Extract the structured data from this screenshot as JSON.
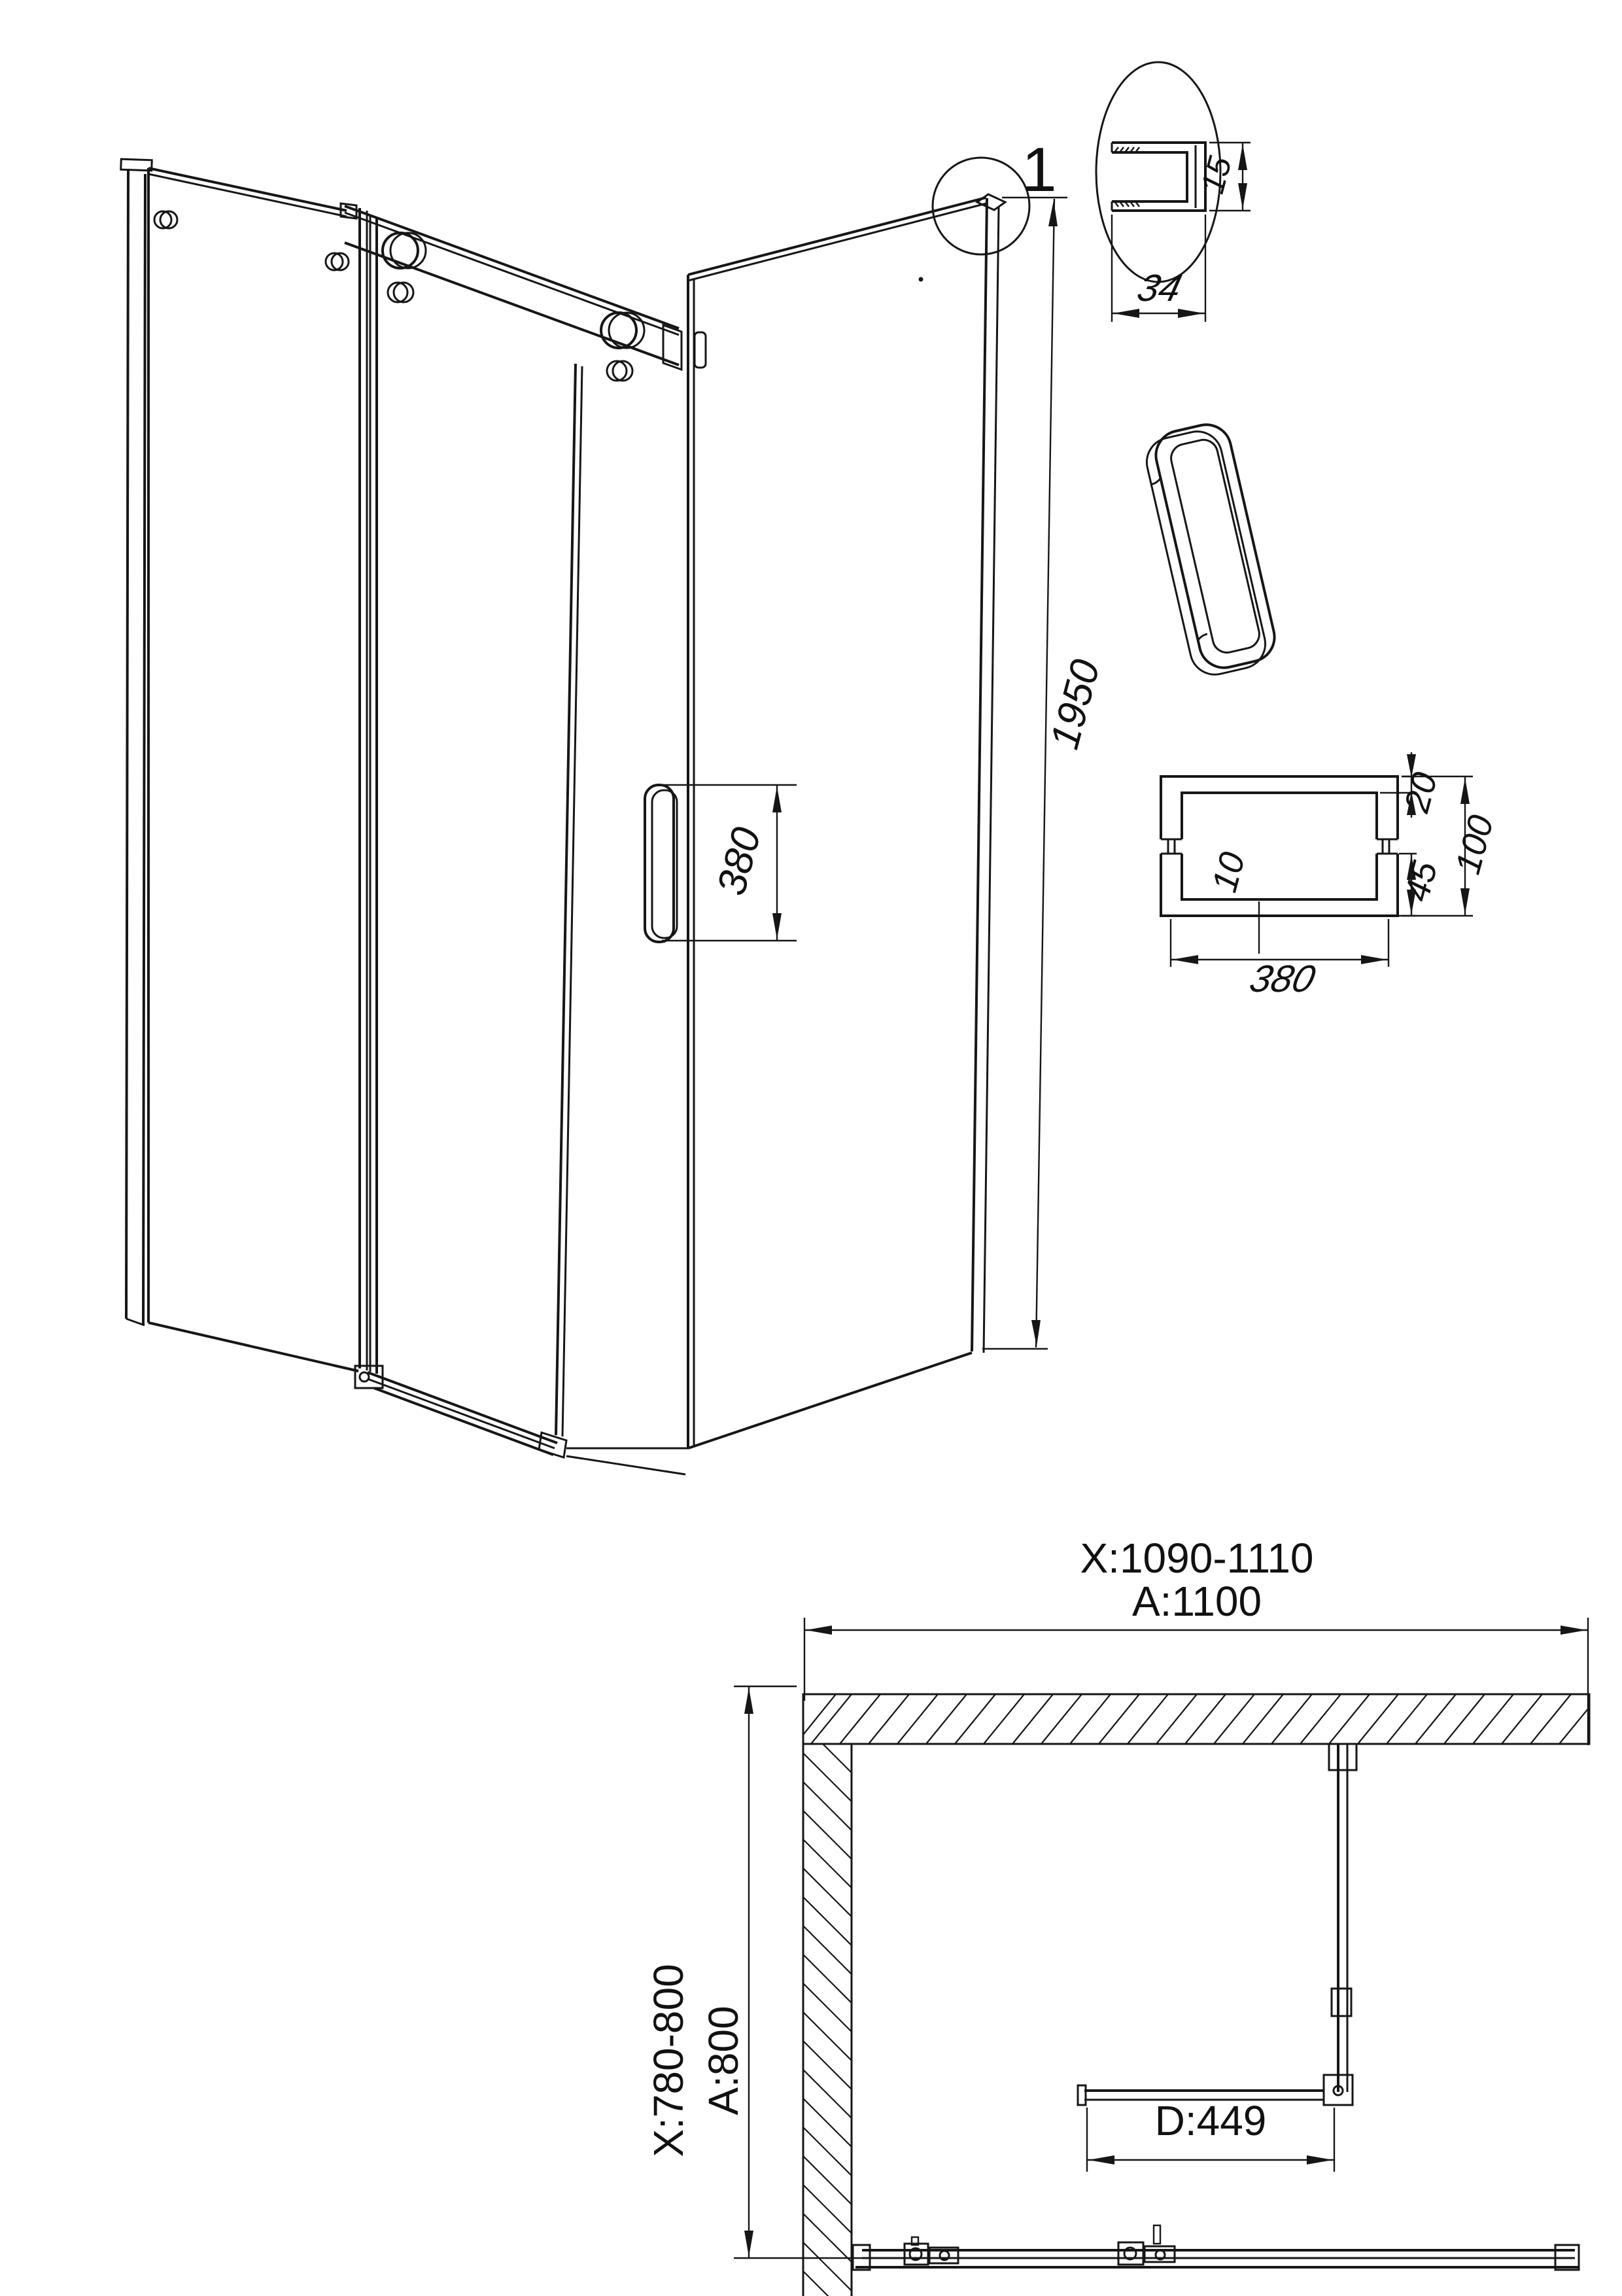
{
  "drawing": {
    "title": "shower-enclosure-technical-drawing",
    "line_color": "#161616",
    "background": "#ffffff",
    "detail_callout": {
      "label": "1",
      "profile_width": "34",
      "profile_depth": "15"
    },
    "isometric": {
      "overall_height": "1950",
      "handle_length": "380"
    },
    "handle_section": {
      "top_wall": "20",
      "total_height": "100",
      "inner_gap": "10",
      "post_height": "45",
      "length": "380"
    },
    "plan": {
      "width_adjust_range": "X:1090-1110",
      "width_nominal": "A:1100",
      "depth_adjust_range": "X:780-800",
      "depth_nominal": "A:800",
      "door_width": "D:449"
    }
  }
}
